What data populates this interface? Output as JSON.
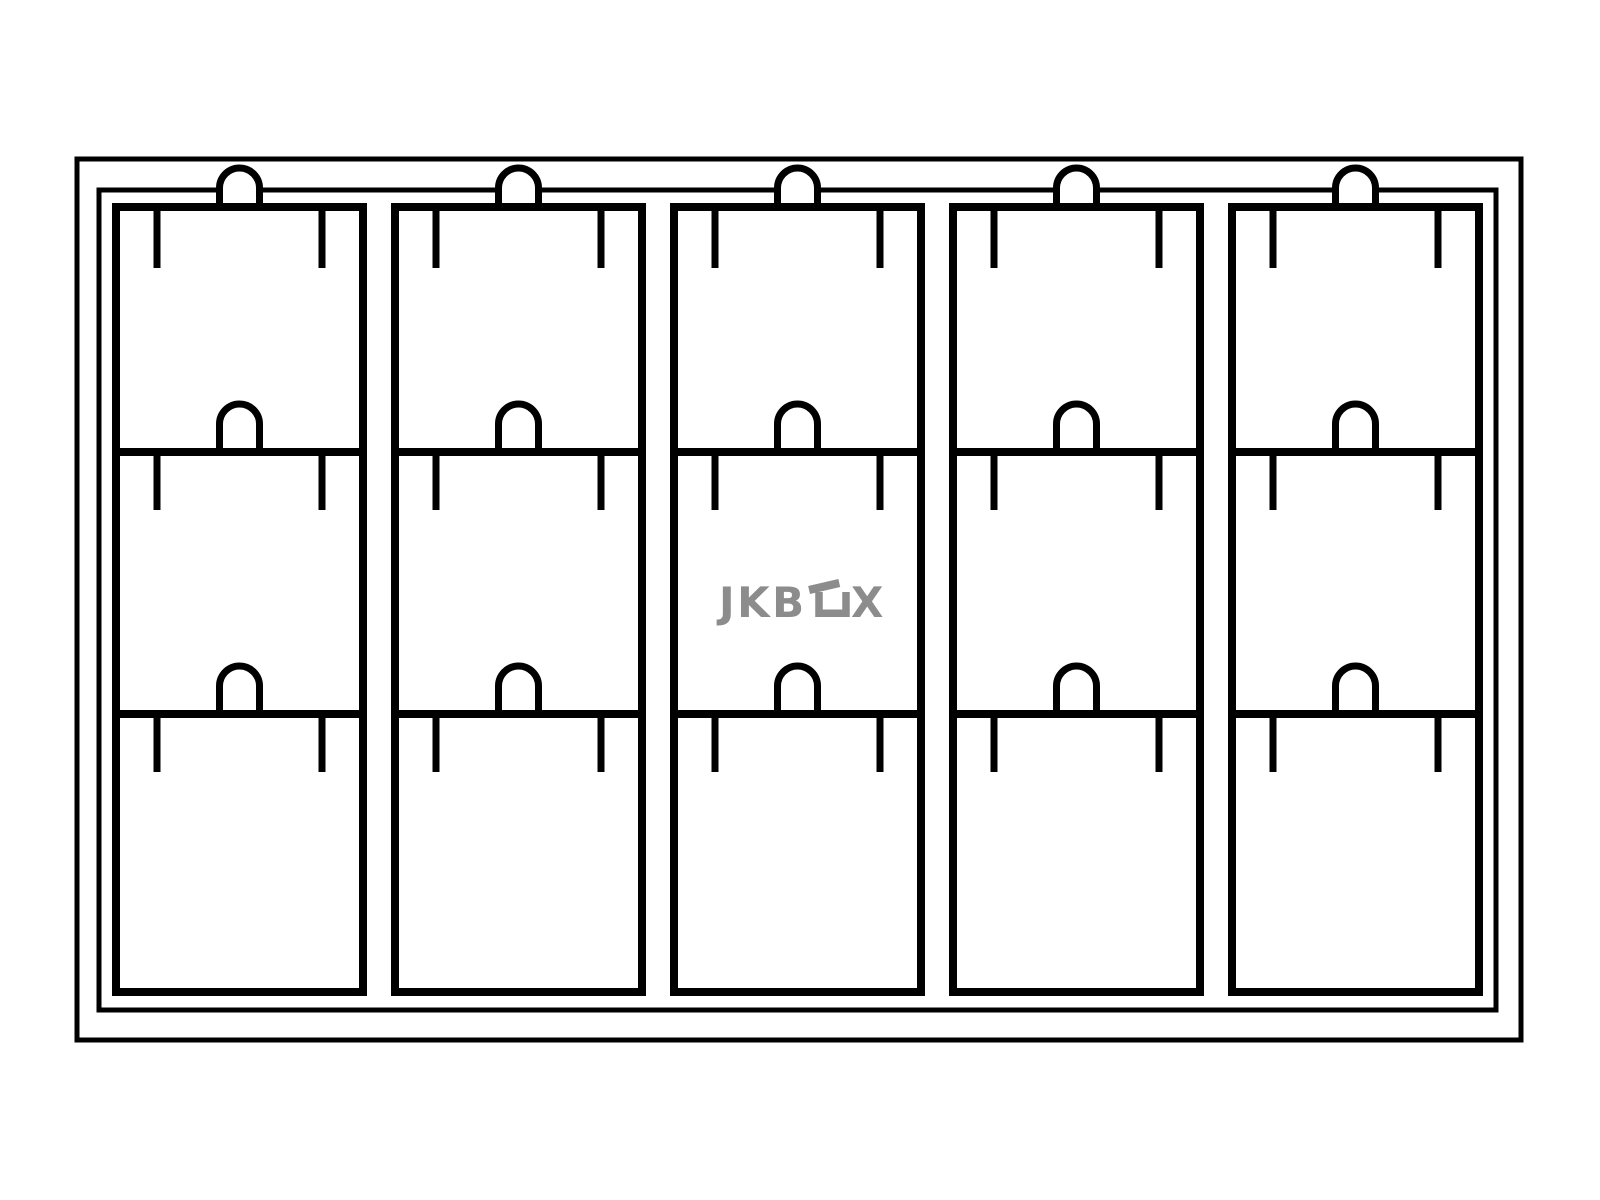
{
  "colors": {
    "line": "#000000",
    "logo": "#8C8C8C",
    "background": "#FFFFFF"
  },
  "logo": {
    "text": "JKBOX",
    "part_jkb": "JKB",
    "part_x": "X"
  },
  "tray": {
    "columns": 5,
    "rows": 3,
    "compartments": 15,
    "thumb_notches_per_column": 3,
    "prong_ticks_per_compartment": 2
  }
}
